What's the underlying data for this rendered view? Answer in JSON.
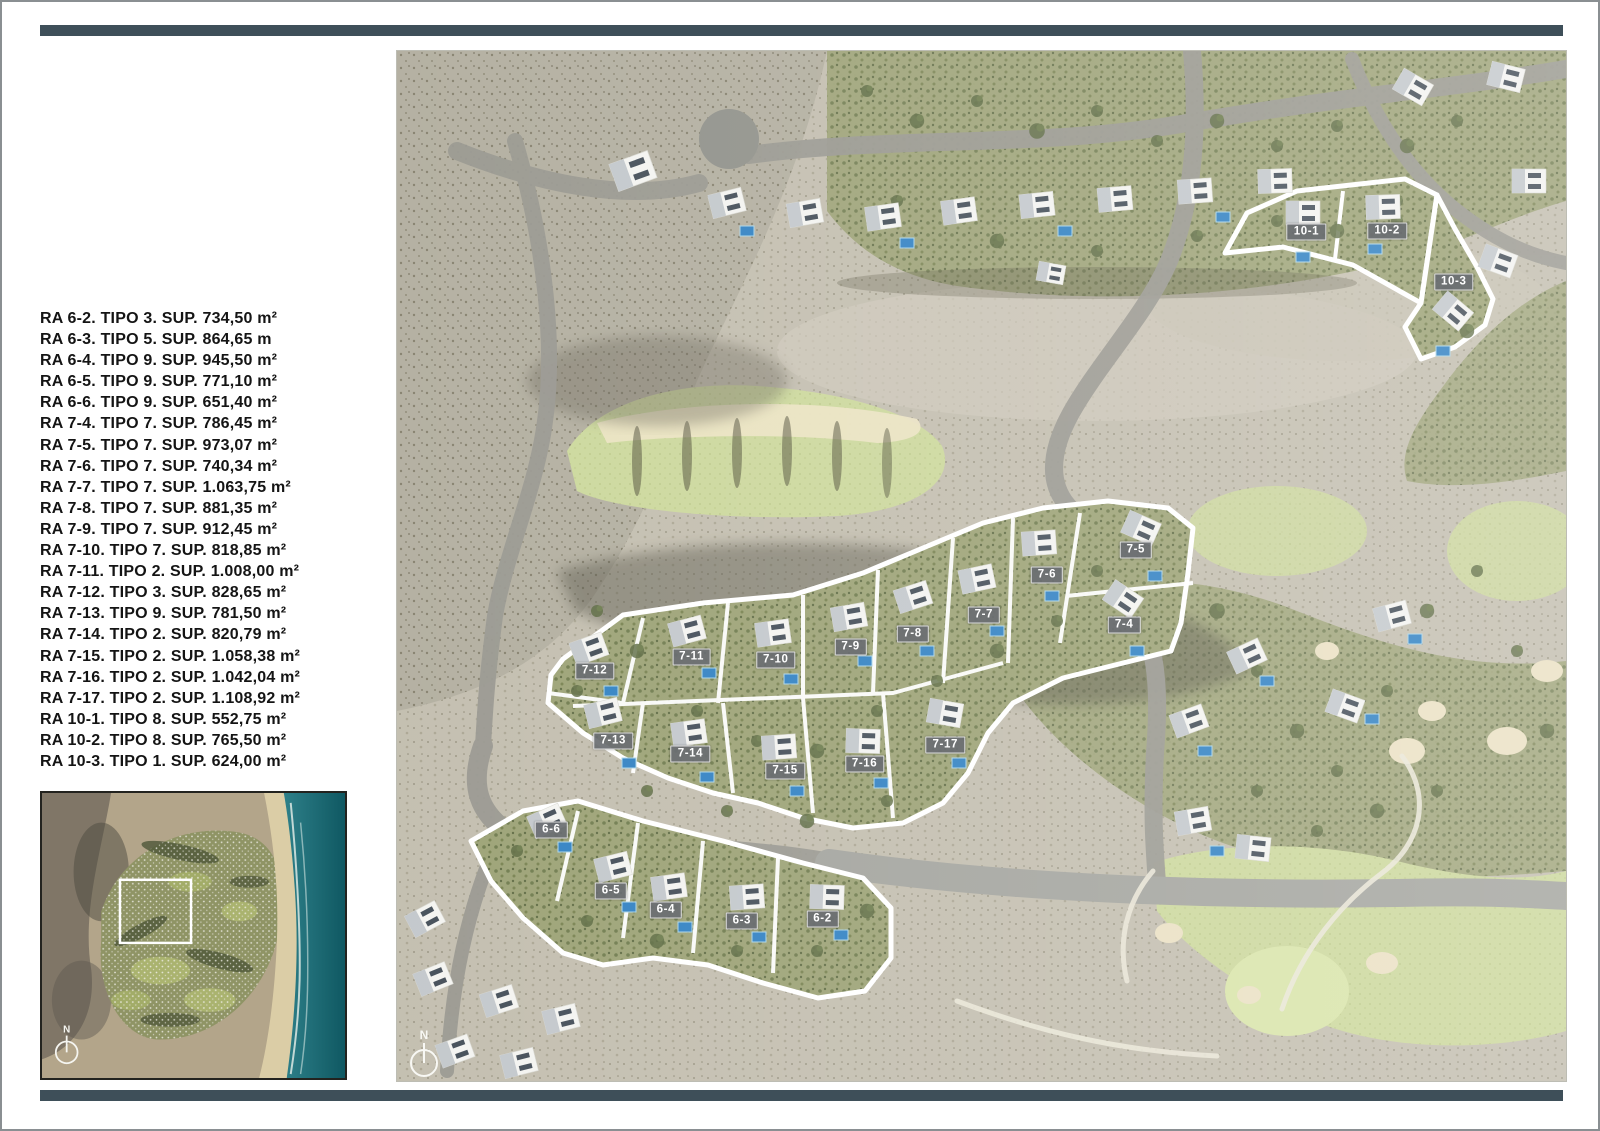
{
  "colors": {
    "accent_bar": "#3E4F59",
    "badge_bg": "#6A6E72",
    "badge_text": "#FFFFFF",
    "parcel_outline": "#FFFFFF",
    "legend_text": "#141414",
    "fairway_green": "#CBD79B",
    "sand_bunker": "#EAE0C2",
    "pool_blue": "#2F80C2",
    "sea_teal": "#156069"
  },
  "legend": {
    "items": [
      "RA 6-2. TIPO 3. SUP. 734,50 m²",
      "RA 6-3. TIPO 5. SUP. 864,65 m",
      "RA 6-4. TIPO 9. SUP. 945,50 m²",
      "RA 6-5. TIPO 9. SUP. 771,10 m²",
      "RA 6-6. TIPO 9. SUP. 651,40 m²",
      "RA 7-4. TIPO 7. SUP. 786,45 m²",
      "RA 7-5. TIPO 7. SUP. 973,07 m²",
      "RA 7-6. TIPO 7. SUP. 740,34 m²",
      "RA 7-7. TIPO 7. SUP. 1.063,75 m²",
      "RA 7-8. TIPO 7. SUP. 881,35 m²",
      "RA 7-9. TIPO 7. SUP. 912,45 m²",
      "RA 7-10. TIPO 7. SUP. 818,85 m²",
      "RA 7-11. TIPO 2. SUP. 1.008,00 m²",
      "RA 7-12. TIPO 3. SUP. 828,65 m²",
      "RA 7-13. TIPO 9. SUP. 781,50 m²",
      "RA 7-14. TIPO 2. SUP. 820,79 m²",
      "RA 7-15. TIPO 2. SUP. 1.058,38 m²",
      "RA 7-16. TIPO 2. SUP. 1.042,04 m²",
      "RA 7-17. TIPO 2. SUP. 1.108,92 m²",
      "RA 10-1. TIPO 8. SUP. 552,75 m²",
      "RA 10-2. TIPO 8. SUP. 765,50 m²",
      "RA 10-3. TIPO 1. SUP. 624,00 m²"
    ]
  },
  "map": {
    "north_label": "N",
    "plots": [
      {
        "label": "7-12"
      },
      {
        "label": "7-11"
      },
      {
        "label": "7-10"
      },
      {
        "label": "7-9"
      },
      {
        "label": "7-8"
      },
      {
        "label": "7-7"
      },
      {
        "label": "7-6"
      },
      {
        "label": "7-5"
      },
      {
        "label": "7-4"
      },
      {
        "label": "7-13"
      },
      {
        "label": "7-14"
      },
      {
        "label": "7-15"
      },
      {
        "label": "7-16"
      },
      {
        "label": "7-17"
      },
      {
        "label": "6-6"
      },
      {
        "label": "6-5"
      },
      {
        "label": "6-4"
      },
      {
        "label": "6-3"
      },
      {
        "label": "6-2"
      },
      {
        "label": "10-1"
      },
      {
        "label": "10-2"
      },
      {
        "label": "10-3"
      }
    ]
  },
  "overview": {
    "north_label": "N"
  }
}
